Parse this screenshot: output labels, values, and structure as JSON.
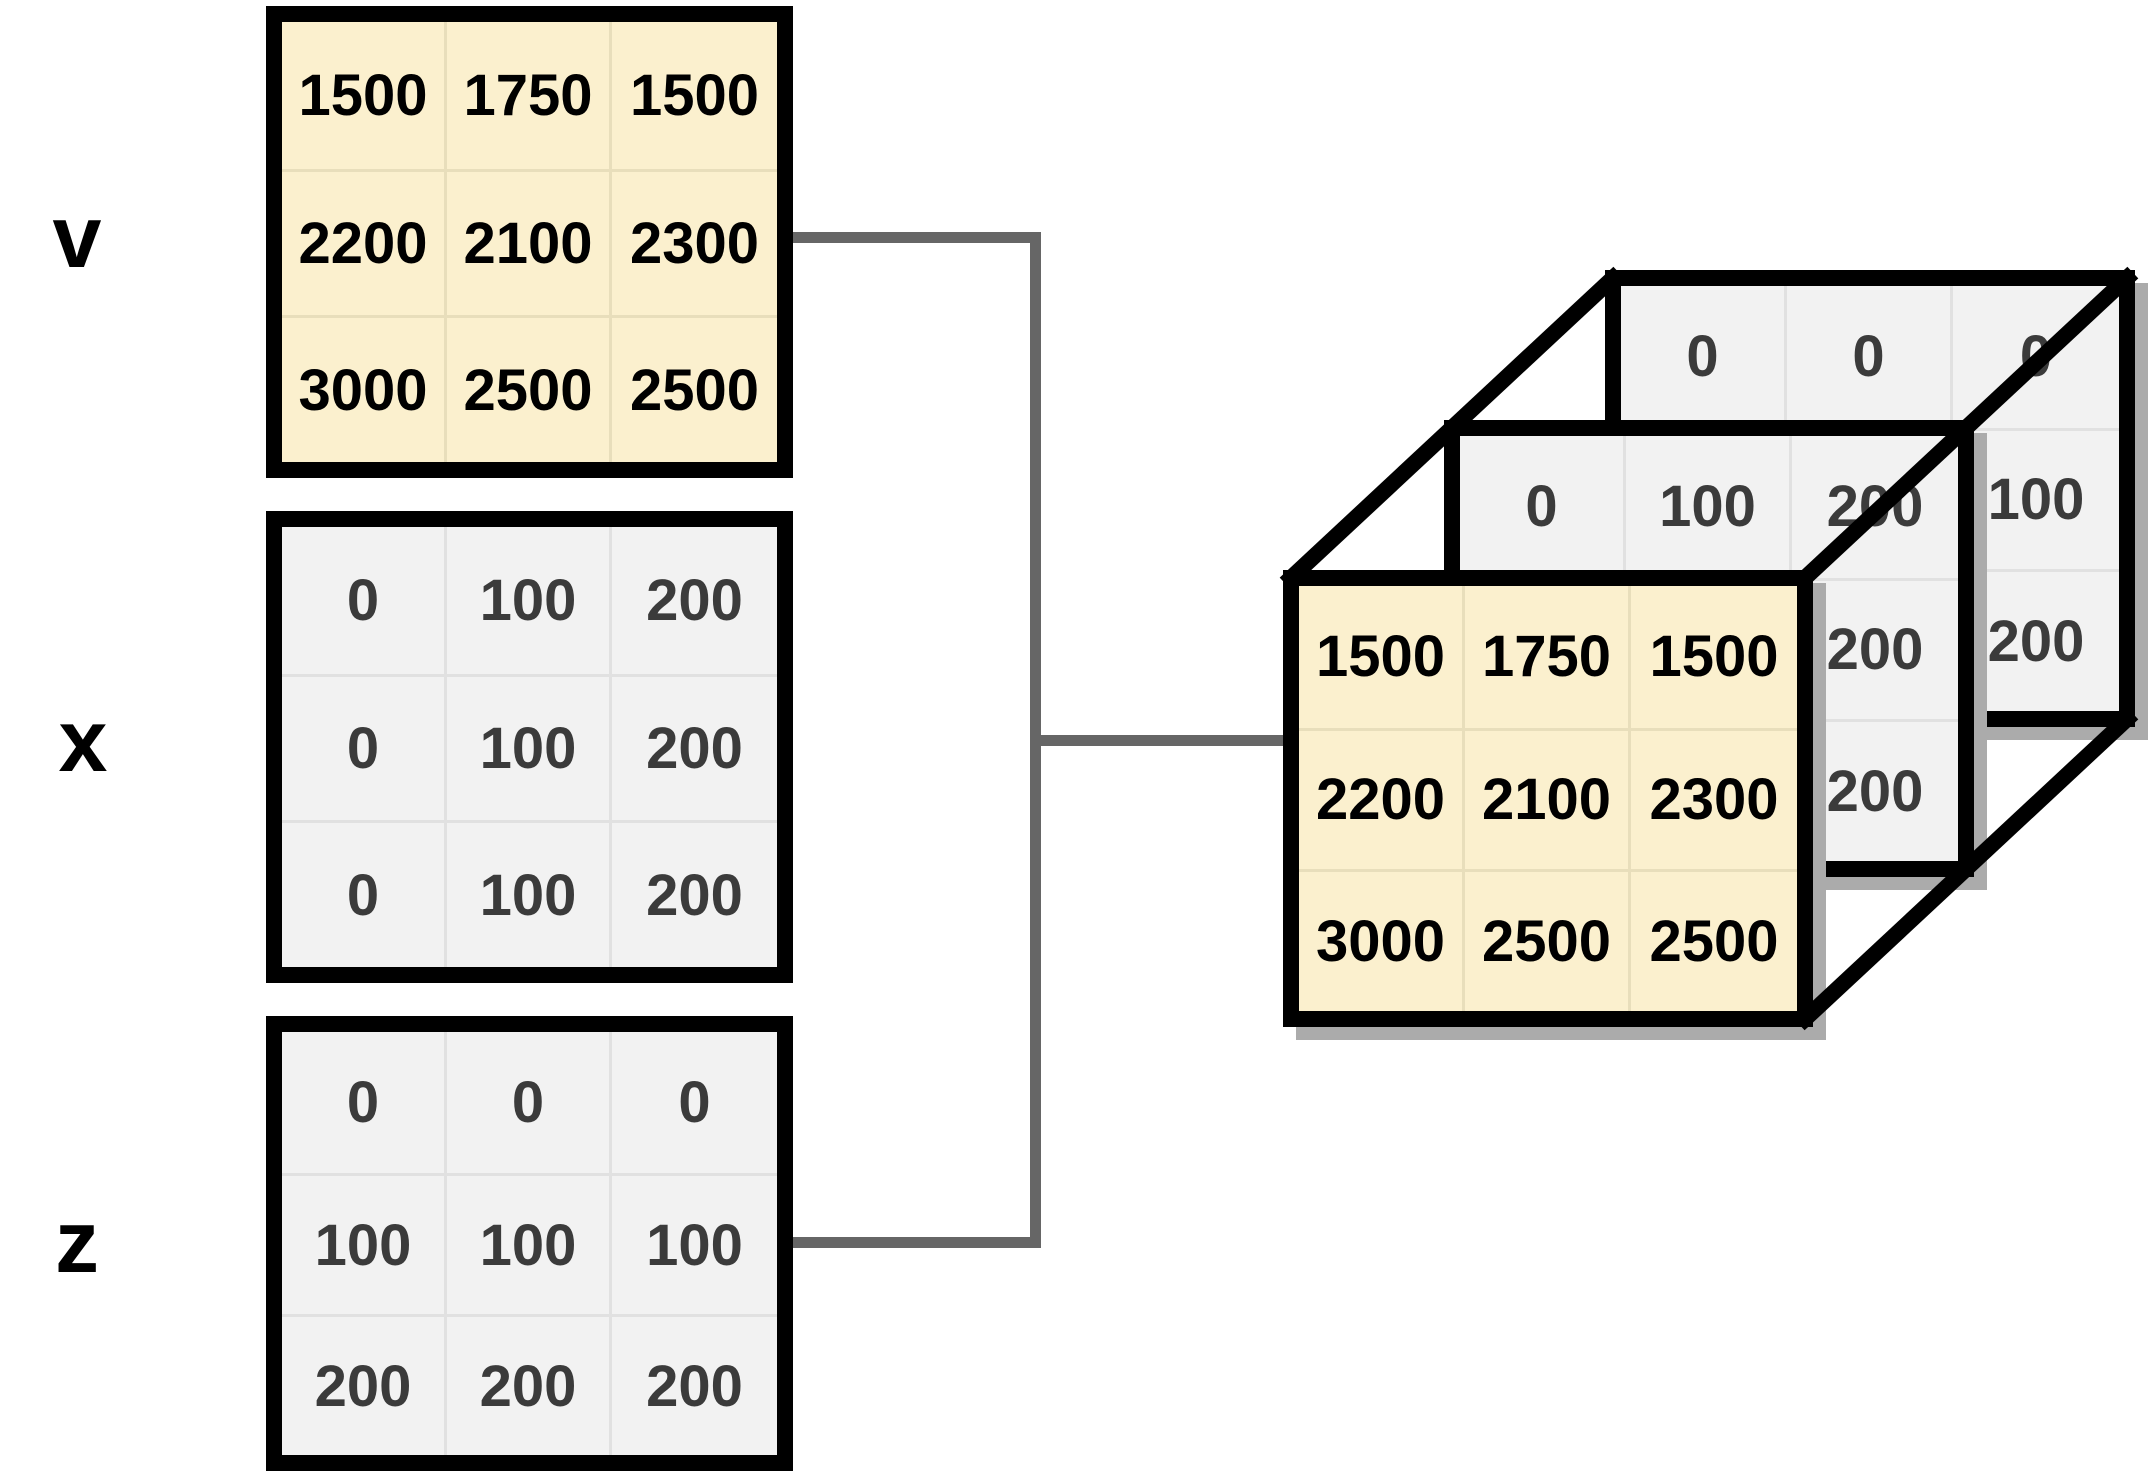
{
  "figure": {
    "title_hidden": "",
    "matrix_labels": {
      "v": "v",
      "x": "x",
      "z": "z"
    },
    "matrices": {
      "v": [
        [
          "1500",
          "1750",
          "1500"
        ],
        [
          "2200",
          "2100",
          "2300"
        ],
        [
          "3000",
          "2500",
          "2500"
        ]
      ],
      "x": [
        [
          "0",
          "100",
          "200"
        ],
        [
          "0",
          "100",
          "200"
        ],
        [
          "0",
          "100",
          "200"
        ]
      ],
      "z": [
        [
          "0",
          "0",
          "0"
        ],
        [
          "100",
          "100",
          "100"
        ],
        [
          "200",
          "200",
          "200"
        ]
      ]
    },
    "cube": {
      "front_plane_source": "v",
      "middle_plane_source": "x",
      "back_plane_source": "z"
    },
    "colors": {
      "v_fill": "#FBF0CE",
      "gray_fill": "#F2F2F2",
      "border": "#000000",
      "connector": "#666666",
      "muted_text": "#3B3B3B",
      "plane_shadow": "#ABABAB"
    }
  }
}
